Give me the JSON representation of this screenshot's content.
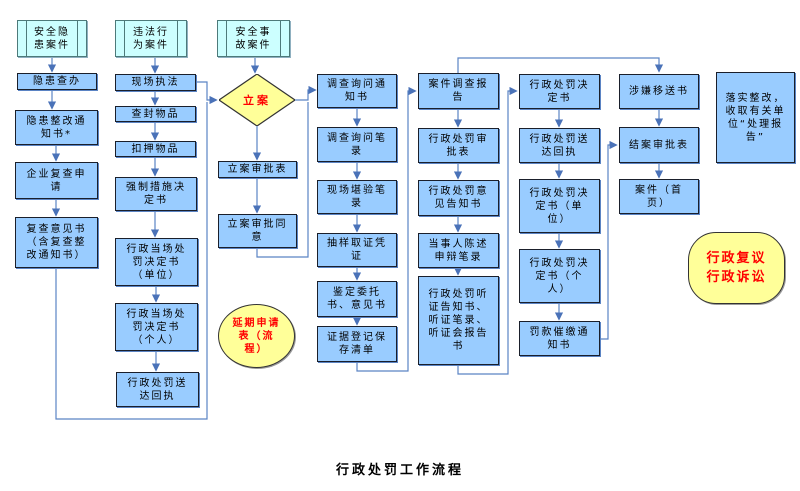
{
  "title": "行政处罚工作流程",
  "colors": {
    "process_fill": "#99ccff",
    "terminal_fill": "#ccffff",
    "highlight_fill": "#ffff99",
    "highlight_text": "#ff0000",
    "connector": "#5b84c4",
    "text": "#000000",
    "background": "#ffffff"
  },
  "nodes": {
    "safety_hazard_case": {
      "label": "安全隐患案件"
    },
    "hazard_investigation": {
      "label": "隐患查办"
    },
    "hazard_rectification_notice": {
      "label": "隐患整改通知书*"
    },
    "enterprise_review_application": {
      "label": "企业复查申请"
    },
    "review_opinion": {
      "label": "复查意见书（含复查整改通知书）"
    },
    "illegal_act_case": {
      "label": "违法行为案件"
    },
    "onsite_enforcement": {
      "label": "现场执法"
    },
    "seal_goods": {
      "label": "查封物品"
    },
    "detain_goods": {
      "label": "扣押物品"
    },
    "compulsory_measure_decision": {
      "label": "强制措施决定书"
    },
    "onspot_penalty_decision_unit": {
      "label": "行政当场处罚决定书（单位）"
    },
    "onspot_penalty_decision_individual": {
      "label": "行政当场处罚决定书（个人）"
    },
    "penalty_delivery_receipt_left": {
      "label": "行政处罚送达回执"
    },
    "accident_case": {
      "label": "安全事故案件"
    },
    "case_filing": {
      "label": "立案"
    },
    "filing_approval_form": {
      "label": "立案审批表"
    },
    "filing_approval_agree": {
      "label": "立案审批同意"
    },
    "extension_application": {
      "label": "延期申请表（流程）"
    },
    "inquiry_notice": {
      "label": "调查询问通知书"
    },
    "inquiry_record": {
      "label": "调查询问笔录"
    },
    "site_survey_record": {
      "label": "现场堪验笔录"
    },
    "sampling_voucher": {
      "label": "抽样取证凭证"
    },
    "appraisal_letters": {
      "label": "鉴定委托书、意见书"
    },
    "evidence_register_list": {
      "label": "证据登记保存清单"
    },
    "case_investigation_report": {
      "label": "案件调查报告"
    },
    "penalty_approval_form": {
      "label": "行政处罚审批表"
    },
    "penalty_opinion_notice": {
      "label": "行政处罚意见告知书"
    },
    "party_statement_record": {
      "label": "当事人陈述申辩笔录"
    },
    "hearing_documents": {
      "label": "行政处罚听证告知书、听证笔录、听证会报告书"
    },
    "penalty_decision": {
      "label": "行政处罚决定书"
    },
    "penalty_delivery_receipt_right": {
      "label": "行政处罚送达回执"
    },
    "penalty_decision_unit": {
      "label": "行政处罚决定书（单位）"
    },
    "penalty_decision_individual": {
      "label": "行政处罚决定书（个人）"
    },
    "fine_reminder_notice": {
      "label": "罚款催缴通知书"
    },
    "suspected_transfer_letter": {
      "label": "涉嫌移送书"
    },
    "case_closing_approval": {
      "label": "结案审批表"
    },
    "case_homepage": {
      "label": "案件（首页）"
    },
    "implement_rectification": {
      "label": "落实整改，收取有关单位“处理报告”"
    },
    "reconsideration_litigation": {
      "label": "行政复议行政诉讼"
    }
  }
}
